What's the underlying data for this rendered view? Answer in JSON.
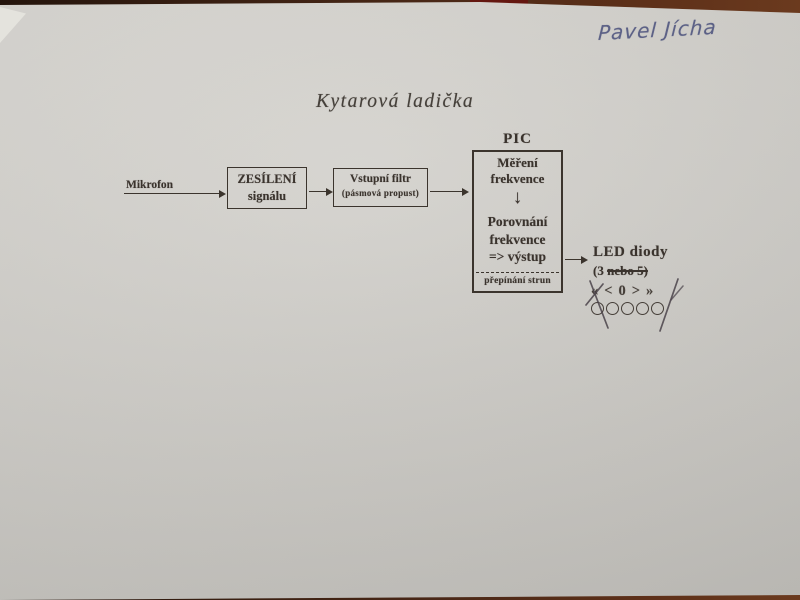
{
  "photo": {
    "handwritten_name": "Pavel Jícha",
    "title": "Kytarová ladička"
  },
  "diagram": {
    "mikrofon_label": "Mikrofon",
    "amplifier_box": {
      "line1": "ZESÍLENÍ",
      "line2": "signálu"
    },
    "filter_box": {
      "line1": "Vstupní filtr",
      "line2": "(pásmová propust)"
    },
    "pic": {
      "label": "PIC",
      "measure_line1": "Měření",
      "measure_line2": "frekvence",
      "down_arrow": "↓",
      "compare_line1": "Porovnání",
      "compare_line2": "frekvence",
      "compare_line3": "=> výstup",
      "bottom_label": "přepínání strun"
    },
    "led": {
      "label": "LED diody",
      "count_prefix": "(3 ",
      "count_struck": "nebo 5)",
      "symbols": [
        "«",
        "<",
        "0",
        ">",
        "»"
      ],
      "circle_count": 5
    }
  },
  "colors": {
    "paper": "#d0cec9",
    "background": "#4a2817",
    "ink": "#3a332d",
    "handwriting_ink": "#5c6186"
  }
}
